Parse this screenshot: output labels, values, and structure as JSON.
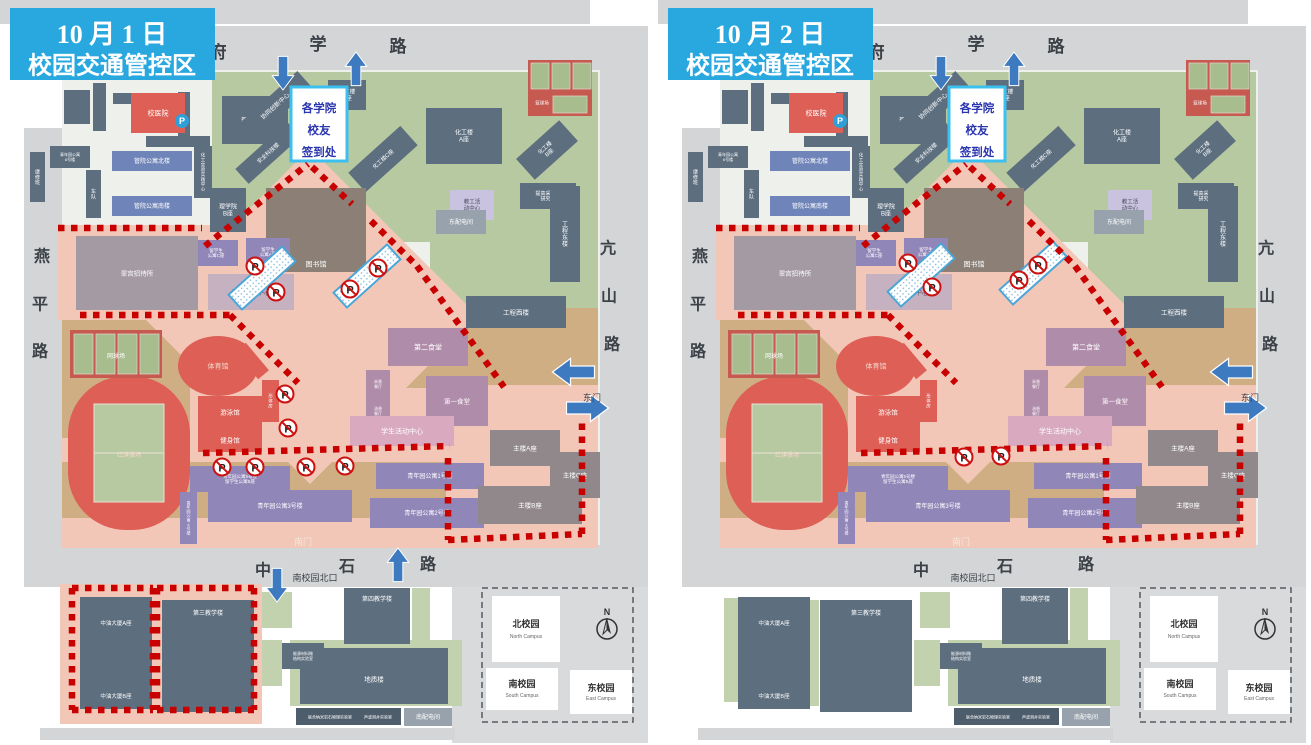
{
  "palette": {
    "road": "#d3d5d7",
    "outside": "#d8dadc",
    "campus": "#eef0ec",
    "green": "#b7c9a0",
    "green2": "#c3d2ae",
    "tan": "#cfae84",
    "pink": "#f2c7b7",
    "zone": "#c80000",
    "arrow": "#3d7ac0",
    "title_bg": "#29a8e0",
    "title_fg": "#ffffff",
    "signin_border": "#3bc0ef",
    "signin_fg": "#2a35b0",
    "barrier_border": "#4aa6d8",
    "court": "#a8bd8e",
    "court_red": "#c65a50",
    "ink": "#3c4148",
    "grey": "#5d6e7f",
    "grey2": "#4e5d6c",
    "lgrey": "#97a2ac",
    "red": "#de5f55",
    "blue": "#6f84b8",
    "purple": "#9186b8",
    "lpurple": "#c9c3e0",
    "mauve": "#b08cab",
    "pinkb": "#d9a9c0",
    "hotel": "#a39aa4",
    "intl": "#c6b1c0",
    "lib": "#8b7f76",
    "main": "#91888b",
    "parking_blue": "#2f9fd8"
  },
  "signin": {
    "lines": [
      "各学院",
      "校友",
      "签到处"
    ]
  },
  "base": {
    "texts": [
      {
        "t": "府",
        "x": 218,
        "y": 52,
        "fs": 17
      },
      {
        "t": "学",
        "x": 318,
        "y": 44,
        "fs": 17
      },
      {
        "t": "路",
        "x": 398,
        "y": 46,
        "fs": 17
      },
      {
        "t": "燕",
        "x": 42,
        "y": 256,
        "fs": 16
      },
      {
        "t": "平",
        "x": 40,
        "y": 304,
        "fs": 16
      },
      {
        "t": "路",
        "x": 40,
        "y": 351,
        "fs": 16
      },
      {
        "t": "亢",
        "x": 608,
        "y": 248,
        "fs": 16
      },
      {
        "t": "山",
        "x": 609,
        "y": 296,
        "fs": 16
      },
      {
        "t": "路",
        "x": 612,
        "y": 344,
        "fs": 16
      },
      {
        "t": "中",
        "x": 263,
        "y": 570,
        "fs": 16
      },
      {
        "t": "石",
        "x": 347,
        "y": 566,
        "fs": 16
      },
      {
        "t": "路",
        "x": 428,
        "y": 564,
        "fs": 16
      },
      {
        "t": "北门",
        "x": 189,
        "y": 75,
        "fs": 9
      },
      {
        "t": "南门",
        "x": 303,
        "y": 542,
        "fs": 9,
        "c": "#f2e8dc"
      },
      {
        "t": "东门",
        "x": 592,
        "y": 398,
        "fs": 9
      },
      {
        "t": "南校园北口",
        "x": 315,
        "y": 578,
        "fs": 9
      },
      {
        "t": "联合纳米岩石物理实验室",
        "x": 330,
        "y": 717,
        "fs": 4,
        "c": "#ffffff"
      },
      {
        "t": "声波测井实验室",
        "x": 378,
        "y": 717,
        "fs": 4,
        "c": "#ffffff"
      }
    ],
    "buildings": [
      {
        "x": 93,
        "y": 83,
        "w": 13,
        "h": 48,
        "t": ""
      },
      {
        "x": 113,
        "y": 93,
        "w": 42,
        "h": 11,
        "t": ""
      },
      {
        "x": 178,
        "y": 92,
        "w": 12,
        "h": 44,
        "t": ""
      },
      {
        "x": 146,
        "y": 136,
        "w": 64,
        "h": 11,
        "t": ""
      },
      {
        "x": 64,
        "y": 90,
        "w": 26,
        "h": 34,
        "t": ""
      },
      {
        "x": 131,
        "y": 93,
        "w": 54,
        "h": 40,
        "c": "red",
        "t": "校医院",
        "fs": 7
      },
      {
        "x": 222,
        "y": 96,
        "w": 66,
        "h": 48,
        "t": "理学院A座",
        "fs": 6
      },
      {
        "x": 112,
        "y": 151,
        "w": 80,
        "h": 20,
        "c": "blue",
        "t": "管院公寓北楼",
        "fs": 6
      },
      {
        "x": 112,
        "y": 196,
        "w": 80,
        "h": 20,
        "c": "blue",
        "t": "管院公寓南楼",
        "fs": 6
      },
      {
        "x": 50,
        "y": 146,
        "w": 40,
        "h": 22,
        "t": "青年园公寓\n6号楼",
        "fs": 4
      },
      {
        "x": 30,
        "y": 152,
        "w": 15,
        "h": 50,
        "t": "继修班",
        "fs": 5,
        "v": 1
      },
      {
        "x": 86,
        "y": 170,
        "w": 15,
        "h": 48,
        "t": "车队",
        "fs": 5,
        "v": 1
      },
      {
        "x": 194,
        "y": 146,
        "w": 18,
        "h": 52,
        "t": "化工实验实践中心",
        "fs": 4.5,
        "v": 1
      },
      {
        "x": 210,
        "y": 188,
        "w": 36,
        "h": 44,
        "t": "理学院\nB座",
        "fs": 6
      },
      {
        "x": 235,
        "y": 95,
        "w": 80,
        "h": 22,
        "t": "协同创新中心",
        "fs": 6,
        "r": -42
      },
      {
        "x": 328,
        "y": 80,
        "w": 38,
        "h": 30,
        "t": "化工楼\nD座",
        "fs": 5.5
      },
      {
        "x": 233,
        "y": 143,
        "w": 70,
        "h": 20,
        "t": "安全科技楼",
        "fs": 5.5,
        "r": -42
      },
      {
        "x": 348,
        "y": 146,
        "w": 70,
        "h": 26,
        "t": "化工楼C座",
        "fs": 5.5,
        "r": -42
      },
      {
        "x": 426,
        "y": 108,
        "w": 76,
        "h": 56,
        "t": "化工楼\nA座",
        "fs": 6
      },
      {
        "x": 518,
        "y": 136,
        "w": 58,
        "h": 28,
        "t": "化工楼\nB座",
        "fs": 5.5,
        "r": -42
      },
      {
        "x": 520,
        "y": 183,
        "w": 56,
        "h": 26,
        "t": "提高采收率\n研究院",
        "fs": 5
      },
      {
        "x": 450,
        "y": 190,
        "w": 44,
        "h": 30,
        "c": "lpurple",
        "t": "教工活\n动中心",
        "fs": 5.5,
        "tc": "#4a4a5a"
      },
      {
        "x": 436,
        "y": 210,
        "w": 50,
        "h": 24,
        "c": "lgrey",
        "t": "东配电间",
        "fs": 6
      },
      {
        "x": 550,
        "y": 186,
        "w": 30,
        "h": 96,
        "t": "工程东楼",
        "fs": 6,
        "v": 1
      },
      {
        "x": 466,
        "y": 296,
        "w": 100,
        "h": 32,
        "t": "工程西楼",
        "fs": 6.5
      },
      {
        "x": 266,
        "y": 188,
        "w": 100,
        "h": 84,
        "c": "lib",
        "t": "图书馆",
        "fs": 7,
        "ty": 264
      },
      {
        "x": 194,
        "y": 240,
        "w": 44,
        "h": 26,
        "c": "purple",
        "t": "留学生\n公寓C座",
        "fs": 4.5
      },
      {
        "x": 246,
        "y": 238,
        "w": 44,
        "h": 28,
        "c": "purple",
        "t": "留学生\n公寓A座",
        "fs": 4.5
      },
      {
        "x": 76,
        "y": 236,
        "w": 122,
        "h": 74,
        "c": "hotel",
        "t": "翠宫招待所",
        "fs": 6.5
      },
      {
        "x": 208,
        "y": 274,
        "w": 86,
        "h": 36,
        "c": "intl",
        "t": "国际交流中心",
        "fs": 6.5,
        "tc": "#584b5e"
      },
      {
        "x": 198,
        "y": 396,
        "w": 64,
        "h": 32,
        "c": "red",
        "t": "游泳馆",
        "fs": 6.5
      },
      {
        "x": 198,
        "y": 428,
        "w": 64,
        "h": 24,
        "c": "red",
        "t": "健身馆",
        "fs": 6.5
      },
      {
        "x": 262,
        "y": 380,
        "w": 17,
        "h": 42,
        "c": "red",
        "t": "形体房",
        "fs": 4.5,
        "v": 1
      },
      {
        "x": 245,
        "y": 343,
        "w": 14,
        "h": 36,
        "c": "red",
        "t": "",
        "r": -40
      },
      {
        "x": 388,
        "y": 328,
        "w": 80,
        "h": 38,
        "c": "mauve",
        "t": "第二食堂",
        "fs": 7
      },
      {
        "x": 366,
        "y": 370,
        "w": 24,
        "h": 28,
        "c": "mauve",
        "t": "米香\n餐厅",
        "fs": 4
      },
      {
        "x": 366,
        "y": 398,
        "w": 24,
        "h": 26,
        "c": "mauve",
        "t": "油香\n餐厅",
        "fs": 4
      },
      {
        "x": 426,
        "y": 376,
        "w": 62,
        "h": 50,
        "c": "mauve",
        "t": "第一食堂",
        "fs": 6.5
      },
      {
        "x": 350,
        "y": 416,
        "w": 104,
        "h": 30,
        "c": "pinkb",
        "t": "学生活动中心",
        "fs": 7
      },
      {
        "x": 190,
        "y": 466,
        "w": 100,
        "h": 26,
        "c": "purple",
        "t": "青年园公寓5号楼\n留学生公寓B座",
        "fs": 4.5
      },
      {
        "x": 180,
        "y": 492,
        "w": 17,
        "h": 52,
        "c": "purple",
        "t": "青年园公寓4号楼",
        "fs": 4,
        "v": 1
      },
      {
        "x": 208,
        "y": 490,
        "w": 144,
        "h": 32,
        "c": "purple",
        "t": "青年园公寓3号楼",
        "fs": 6
      },
      {
        "x": 376,
        "y": 463,
        "w": 108,
        "h": 26,
        "c": "purple",
        "t": "青年园公寓1号楼",
        "fs": 6
      },
      {
        "x": 370,
        "y": 498,
        "w": 114,
        "h": 30,
        "c": "purple",
        "t": "青年园公寓2号楼",
        "fs": 6
      },
      {
        "x": 490,
        "y": 430,
        "w": 70,
        "h": 36,
        "c": "main",
        "t": "主楼A座",
        "fs": 6.5
      },
      {
        "x": 550,
        "y": 452,
        "w": 50,
        "h": 46,
        "c": "main",
        "t": "主楼C座",
        "fs": 6.5
      },
      {
        "x": 478,
        "y": 486,
        "w": 104,
        "h": 38,
        "c": "main",
        "t": "主楼B座",
        "fs": 6.5
      },
      {
        "x": 80,
        "y": 597,
        "w": 72,
        "h": 52,
        "t": "中油大厦A座",
        "fs": 5.5
      },
      {
        "x": 80,
        "y": 649,
        "w": 72,
        "h": 60,
        "t": "中油大厦B座",
        "fs": 5.5,
        "ty": 696
      },
      {
        "x": 162,
        "y": 600,
        "w": 92,
        "h": 112,
        "t": "第三教学楼",
        "fs": 6,
        "ty": 613
      },
      {
        "x": 344,
        "y": 588,
        "w": 66,
        "h": 56,
        "t": "第四教学楼",
        "fs": 6,
        "ty": 599
      },
      {
        "x": 300,
        "y": 648,
        "w": 148,
        "h": 56,
        "t": "地质楼",
        "fs": 6.5,
        "ty": 679
      },
      {
        "x": 282,
        "y": 643,
        "w": 42,
        "h": 26,
        "t": "能源材料微\n结构实验室",
        "fs": 4
      },
      {
        "x": 296,
        "y": 708,
        "w": 105,
        "h": 17,
        "c": "grey2",
        "t": ""
      },
      {
        "x": 404,
        "y": 708,
        "w": 48,
        "h": 18,
        "c": "lgrey",
        "t": "南配电间",
        "fs": 6
      }
    ],
    "stadium": {
      "x": 68,
      "y": 376,
      "w": 122,
      "h": 154,
      "fx": 94,
      "fy": 404,
      "fw": 70,
      "fh": 98,
      "label": "红旗操场",
      "fs": 6
    },
    "gym": {
      "cx": 218,
      "cy": 366,
      "rx": 40,
      "ry": 30,
      "label": "体育馆",
      "fs": 7
    },
    "tennis": {
      "x": 70,
      "y": 330,
      "w": 92,
      "h": 48,
      "label": "网球场",
      "fs": 6
    },
    "basketball": {
      "x": 528,
      "y": 60,
      "w": 64,
      "h": 56,
      "label": "篮球场",
      "fs": 4.5
    },
    "parking_badge": {
      "x": 182,
      "y": 121,
      "label": "P"
    },
    "gate_arrow_label": "箭头",
    "dotted": [
      [
        58,
        228,
        202,
        228
      ],
      [
        80,
        315,
        230,
        315
      ],
      [
        230,
        315,
        298,
        383
      ],
      [
        205,
        246,
        308,
        164
      ],
      [
        312,
        167,
        352,
        204
      ],
      [
        371,
        221,
        417,
        266
      ],
      [
        417,
        266,
        504,
        387
      ],
      [
        203,
        453,
        450,
        446
      ],
      [
        448,
        458,
        448,
        540
      ],
      [
        448,
        540,
        582,
        534
      ],
      [
        582,
        534,
        582,
        419
      ]
    ],
    "inset": {
      "north": "北校园",
      "north_en": "North Campus",
      "south": "南校园",
      "south_en": "South Campus",
      "east": "东校园",
      "east_en": "East Campus",
      "compass": "N"
    }
  },
  "panels": [
    {
      "id": "oct1",
      "title": [
        "10 月 1 日",
        "校园交通管控区"
      ],
      "arrows": [
        {
          "x": 283,
          "y": 72,
          "d": "down",
          "s": 1.2
        },
        {
          "x": 356,
          "y": 70,
          "d": "up",
          "s": 1.2
        },
        {
          "x": 575,
          "y": 372,
          "d": "left",
          "s": 1.5
        },
        {
          "x": 586,
          "y": 408,
          "d": "right",
          "s": 1.5
        },
        {
          "x": 398,
          "y": 566,
          "d": "up",
          "s": 1.2
        },
        {
          "x": 277,
          "y": 584,
          "d": "down",
          "s": 1.2
        }
      ],
      "p_icons": [
        [
          255,
          266
        ],
        [
          276,
          292
        ],
        [
          350,
          289
        ],
        [
          378,
          268
        ],
        [
          285,
          394
        ],
        [
          288,
          428
        ],
        [
          222,
          467
        ],
        [
          255,
          467
        ],
        [
          306,
          467
        ],
        [
          345,
          466
        ]
      ],
      "barriers": [
        {
          "x": 262,
          "y": 278,
          "r": -42
        },
        {
          "x": 367,
          "y": 276,
          "r": -42
        }
      ],
      "extra_dotted_rects": [
        [
          72,
          588,
          81,
          122
        ],
        [
          157,
          588,
          97,
          122
        ]
      ],
      "pink_areas": [
        [
          60,
          584,
          202,
          140
        ]
      ]
    },
    {
      "id": "oct2",
      "title": [
        "10 月 2 日",
        "校园交通管控区"
      ],
      "arrows": [
        {
          "x": 283,
          "y": 72,
          "d": "down",
          "s": 1.2
        },
        {
          "x": 356,
          "y": 70,
          "d": "up",
          "s": 1.2
        },
        {
          "x": 575,
          "y": 372,
          "d": "left",
          "s": 1.5
        },
        {
          "x": 586,
          "y": 408,
          "d": "right",
          "s": 1.5
        }
      ],
      "p_icons": [
        [
          250,
          263
        ],
        [
          274,
          287
        ],
        [
          361,
          280
        ],
        [
          380,
          265
        ],
        [
          306,
          457
        ],
        [
          343,
          456
        ]
      ],
      "barriers": [
        {
          "x": 263,
          "y": 275,
          "r": -42
        },
        {
          "x": 375,
          "y": 273,
          "r": -42
        }
      ],
      "extra_dotted_rects": [],
      "pink_areas": []
    }
  ]
}
